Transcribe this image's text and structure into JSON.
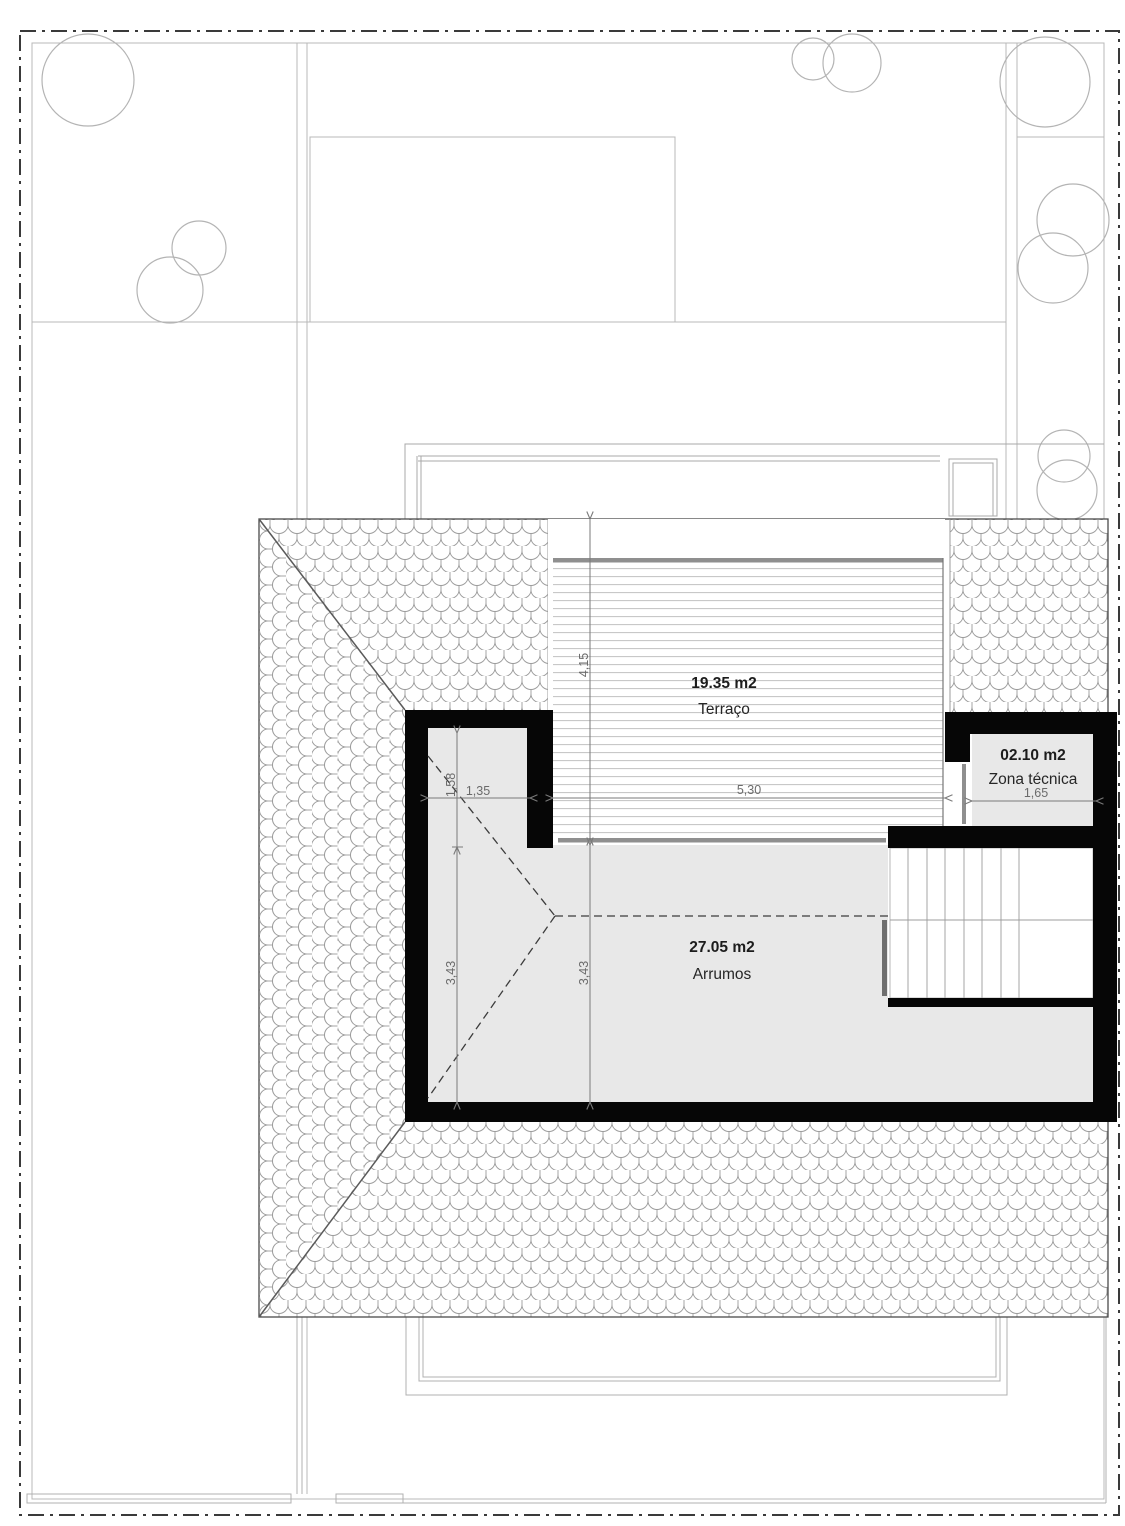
{
  "rooms": {
    "terrace": {
      "area": "19.35 m2",
      "label": "Terraço"
    },
    "technical": {
      "area": "02.10 m2",
      "label": "Zona técnica"
    },
    "storage": {
      "area": "27.05 m2",
      "label": "Arrumos"
    }
  },
  "dims": {
    "terrace_depth": "4,15",
    "terrace_width": "5,30",
    "storage_upper_width": "1,35",
    "storage_upper_depth": "1,58",
    "storage_depth_left": "3,43",
    "storage_depth_mid": "3,43",
    "technical_width": "1,65"
  },
  "colors": {
    "wall": "#060606",
    "room_fill": "#e8e8e8",
    "rail": "#8f8f8f",
    "dimension": "#7a7a7a",
    "boundary": "#3a3a3a",
    "site_line": "#b8b8b8",
    "tile_line": "#9b9b9b",
    "deck_line": "#c2c2c2",
    "stair_line": "#a6a6a6"
  }
}
